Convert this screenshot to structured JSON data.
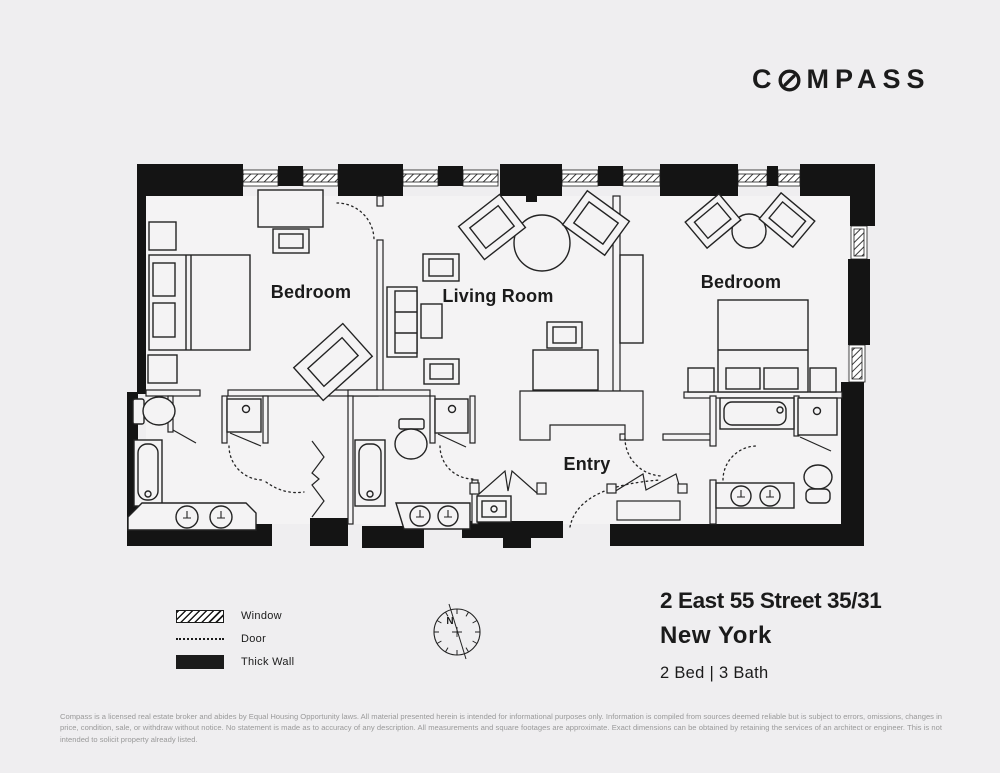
{
  "colors": {
    "background": "#efeef0",
    "ink": "#1b1b1b",
    "muted_text": "#9a9a9a"
  },
  "logo": {
    "prefix": "C",
    "suffix": "MPASS"
  },
  "plan": {
    "rooms": {
      "bedroom_left": "Bedroom",
      "living_room": "Living Room",
      "bedroom_right": "Bedroom",
      "entry": "Entry"
    },
    "north_label": "N"
  },
  "legend": {
    "window": "Window",
    "door": "Door",
    "thick_wall": "Thick Wall"
  },
  "listing": {
    "address": "2 East 55 Street 35/31",
    "city": "New York",
    "beds_baths": "2 Bed | 3 Bath"
  },
  "disclaimer": "Compass is a licensed real estate broker and abides by Equal Housing Opportunity laws. All material presented herein is intended for informational purposes only. Information is compiled from sources deemed reliable but is subject to errors, omissions, changes in price, condition, sale, or withdraw without notice. No statement is made as to accuracy of any description. All measurements and square footages are approximate. Exact dimensions can be obtained by retaining the services of an architect or engineer. This is not intended to solicit property already listed."
}
